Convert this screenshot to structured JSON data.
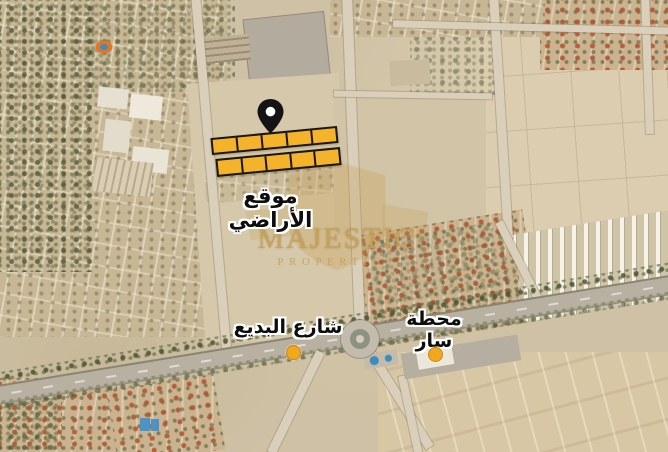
{
  "view": {
    "kind": "satellite-map-flyer",
    "width_px": 668,
    "height_px": 452
  },
  "labels": {
    "site": "موقع الأراضي",
    "road": "شارع البديع",
    "station": "محطة سار"
  },
  "watermark": {
    "brand": "MAJESTIC",
    "tagline": "PROPERTIES",
    "color": "#C79E52"
  },
  "plots": {
    "rows": [
      {
        "cells": 5
      },
      {
        "cells": 5
      }
    ],
    "fill": "#F5B32B",
    "stroke": "#171717"
  },
  "markers": {
    "pin_color": "#141414",
    "dot_color": "#F2A81D"
  }
}
